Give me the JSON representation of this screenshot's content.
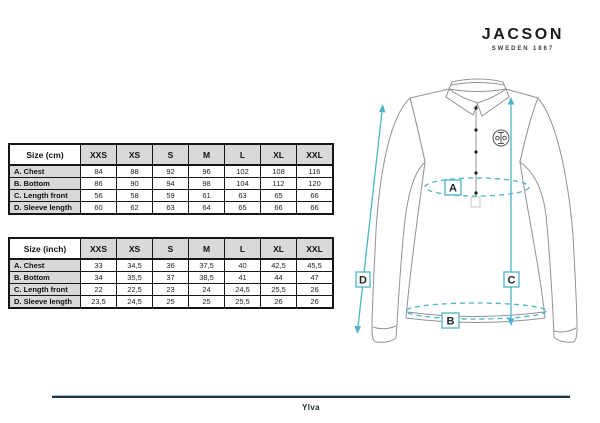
{
  "brand": {
    "name": "JACSON",
    "tagline": "SWEDEN 1867"
  },
  "size_tables": [
    {
      "title": "Size (cm)",
      "sizes": [
        "XXS",
        "XS",
        "S",
        "M",
        "L",
        "XL",
        "XXL"
      ],
      "rows": [
        {
          "label": "A. Chest",
          "values": [
            "84",
            "88",
            "92",
            "96",
            "102",
            "108",
            "116"
          ]
        },
        {
          "label": "B. Bottom",
          "values": [
            "86",
            "90",
            "94",
            "98",
            "104",
            "112",
            "120"
          ]
        },
        {
          "label": "C. Length front",
          "values": [
            "56",
            "58",
            "59",
            "61",
            "63",
            "65",
            "66"
          ]
        },
        {
          "label": "D. Sleeve length",
          "values": [
            "60",
            "62",
            "63",
            "64",
            "65",
            "66",
            "66"
          ]
        }
      ]
    },
    {
      "title": "Size (inch)",
      "sizes": [
        "XXS",
        "XS",
        "S",
        "M",
        "L",
        "XL",
        "XXL"
      ],
      "rows": [
        {
          "label": "A. Chest",
          "values": [
            "33",
            "34,5",
            "36",
            "37,5",
            "40",
            "42,5",
            "45,5"
          ]
        },
        {
          "label": "B. Bottom",
          "values": [
            "34",
            "35,5",
            "37",
            "38,5",
            "41",
            "44",
            "47"
          ]
        },
        {
          "label": "C. Length front",
          "values": [
            "22",
            "22,5",
            "23",
            "24",
            "24,5",
            "25,5",
            "26"
          ]
        },
        {
          "label": "D. Sleeve length",
          "values": [
            "23,5",
            "24,5",
            "25",
            "25",
            "25,5",
            "26",
            "26"
          ]
        }
      ]
    }
  ],
  "diagram": {
    "measure_labels": {
      "chest": "A",
      "bottom": "B",
      "length_front": "C",
      "sleeve_length": "D"
    }
  },
  "footer": {
    "product_name": "Ylva"
  },
  "colors": {
    "accent_teal": "#4db4c7",
    "footer_dark": "#1c3540",
    "table_header_bg": "#d9d9d9"
  }
}
